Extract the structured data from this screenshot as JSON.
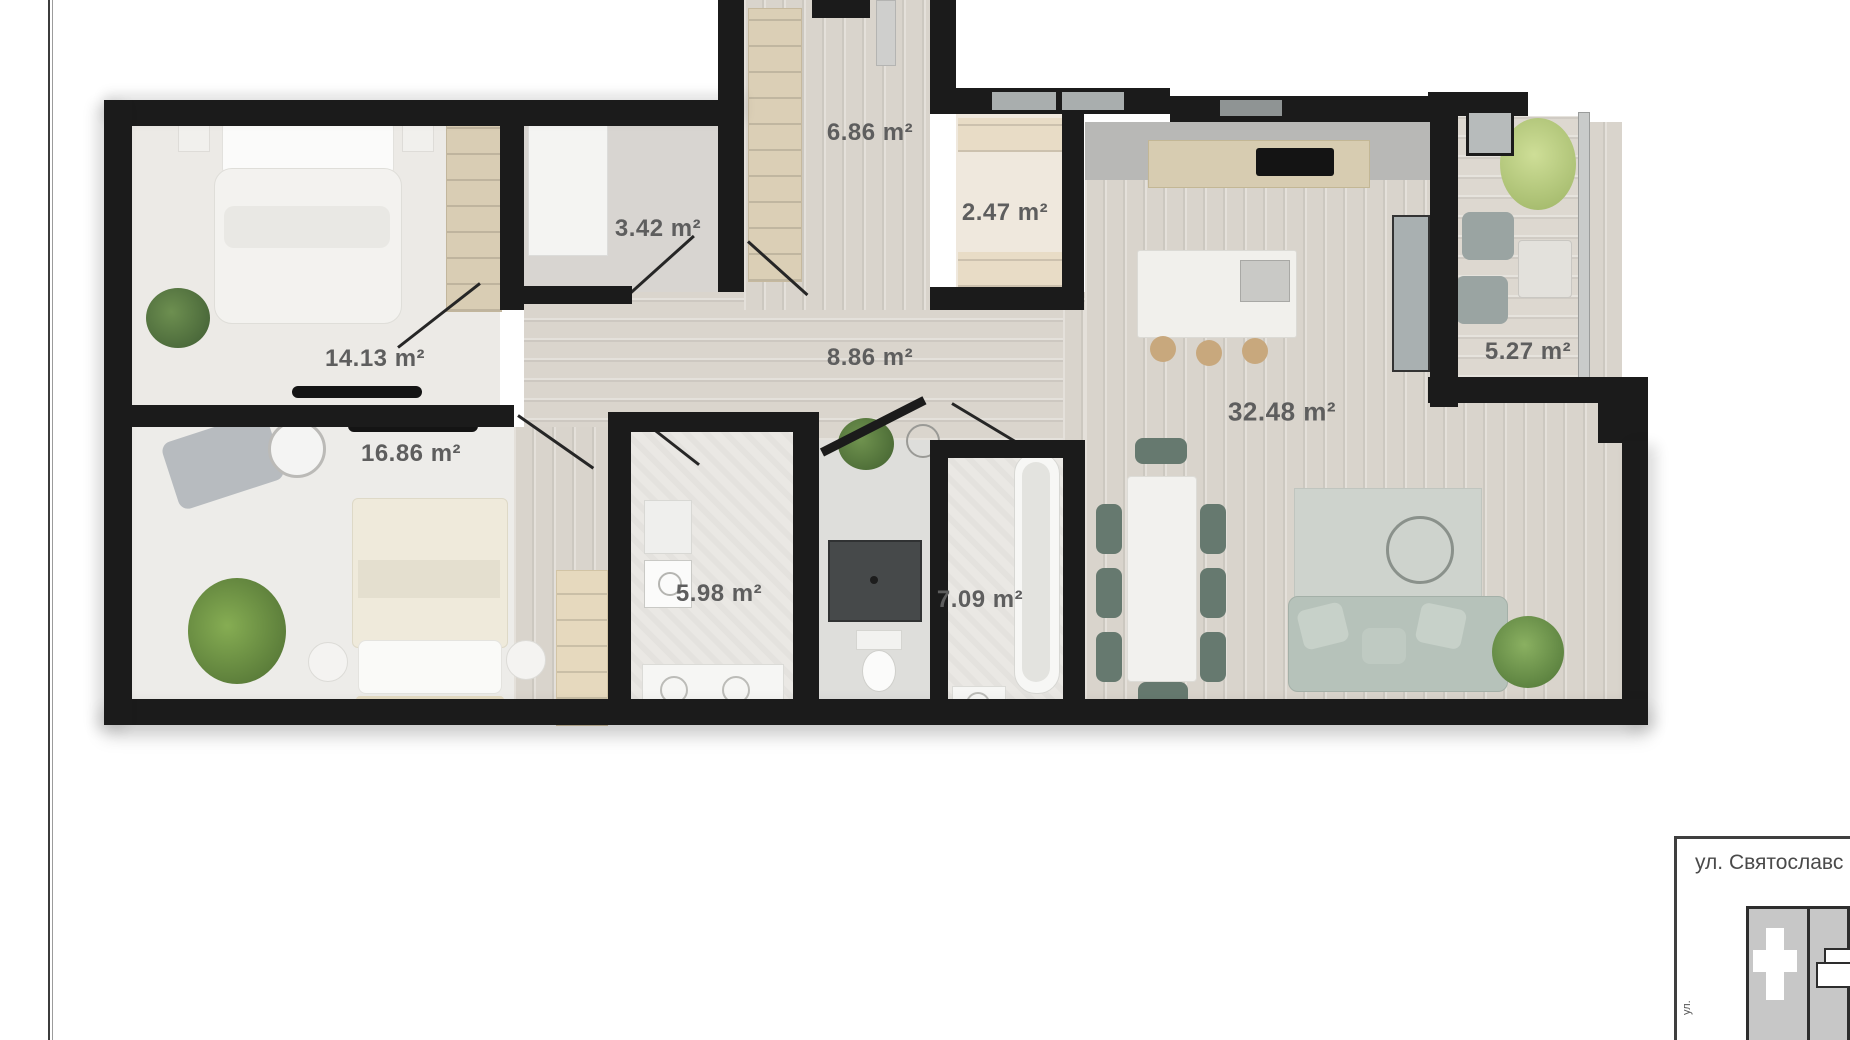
{
  "page": {
    "background_color": "#ffffff",
    "wall_color": "#1b1b1b",
    "label_color": "#5e5e5e",
    "accent_plant_green": "#587a42",
    "accent_sage": "#b6c2ba",
    "accent_chair_green": "#66796f"
  },
  "floor_plan": {
    "type": "apartment-3d-top-view",
    "rooms": [
      {
        "id": "entry-hall",
        "area_label": "6.86 m²"
      },
      {
        "id": "closet",
        "area_label": "3.42 m²"
      },
      {
        "id": "laundry",
        "area_label": "2.47 m²"
      },
      {
        "id": "bedroom-1",
        "area_label": "14.13 m²"
      },
      {
        "id": "corridor",
        "area_label": "8.86 m²"
      },
      {
        "id": "balcony",
        "area_label": "5.27 m²"
      },
      {
        "id": "living-kitchen",
        "area_label": "32.48 m²"
      },
      {
        "id": "bedroom-2",
        "area_label": "16.86 m²"
      },
      {
        "id": "bathroom",
        "area_label": "5.98 m²"
      },
      {
        "id": "wc-bathroom",
        "area_label": "7.09 m²"
      }
    ]
  },
  "location_inset": {
    "street_label": "ул. Святославс",
    "side_label": "ул."
  }
}
